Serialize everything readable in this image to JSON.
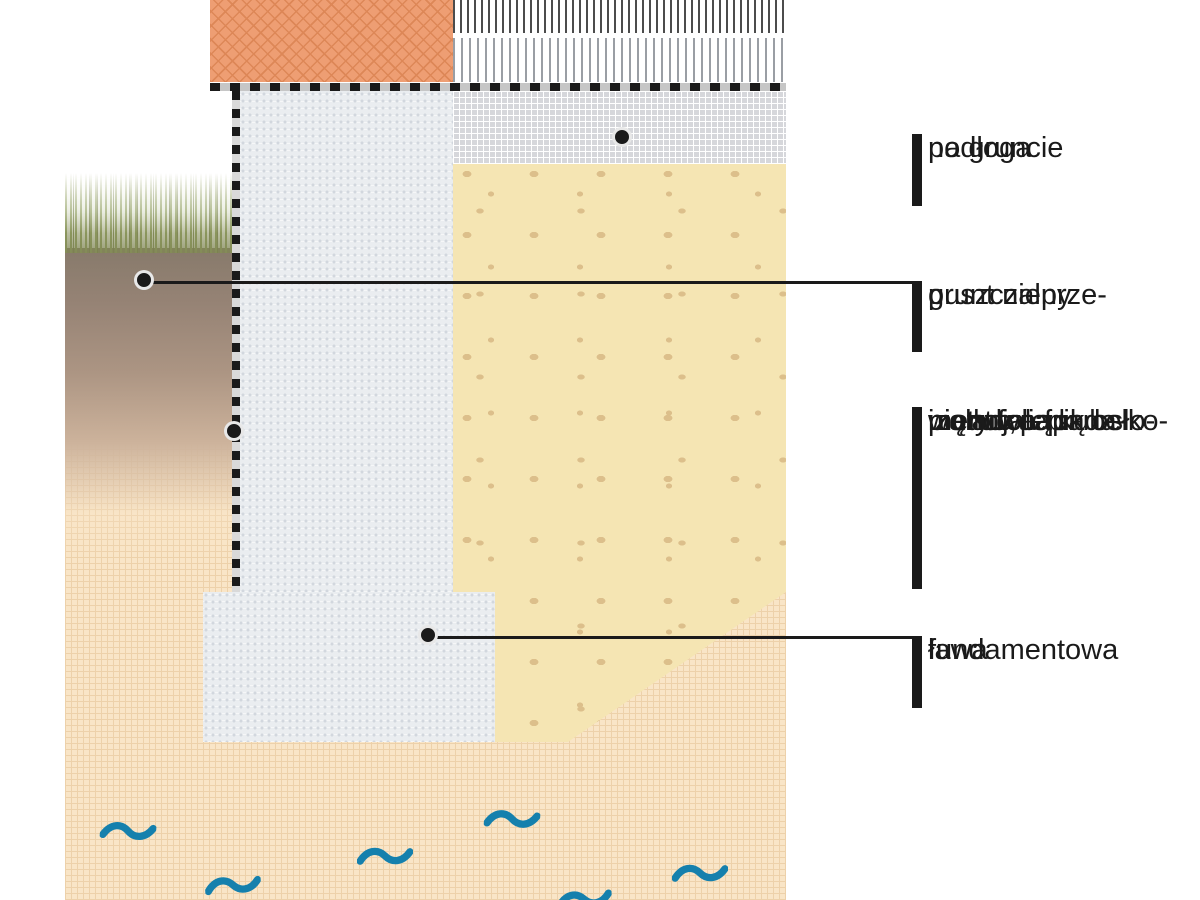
{
  "diagram_type": "foundation-cross-section",
  "labels": [
    {
      "id": "podloga",
      "lines": [
        "podłoga",
        "na gruncie"
      ]
    },
    {
      "id": "grunt",
      "lines": [
        "grunt nieprze-",
        "puszczalny"
      ]
    },
    {
      "id": "izolacja",
      "lines": [
        "izolacja",
        "pionowa funda-",
        "mentu; lepik osło-",
        "nięty folią kubełko-",
        "wą lub papą"
      ]
    },
    {
      "id": "lawa",
      "lines": [
        "ława",
        "fundamentowa"
      ]
    }
  ],
  "colors": {
    "brick": "#EE9E73",
    "brick_hatch": "#DD8757",
    "concrete": "#EAEDF0",
    "concrete_dot": "#D2D7DE",
    "screed": "#D6D7DB",
    "screed_grid": "#FFFFFF",
    "backfill": "#F5E5B3",
    "backfill_speckle": "#DCBF8B",
    "sand": "#F9E5C7",
    "sand_dot": "#EDD1AA",
    "grass": "#93A263",
    "water": "#1580AD",
    "ink": "#1A1A1A"
  }
}
